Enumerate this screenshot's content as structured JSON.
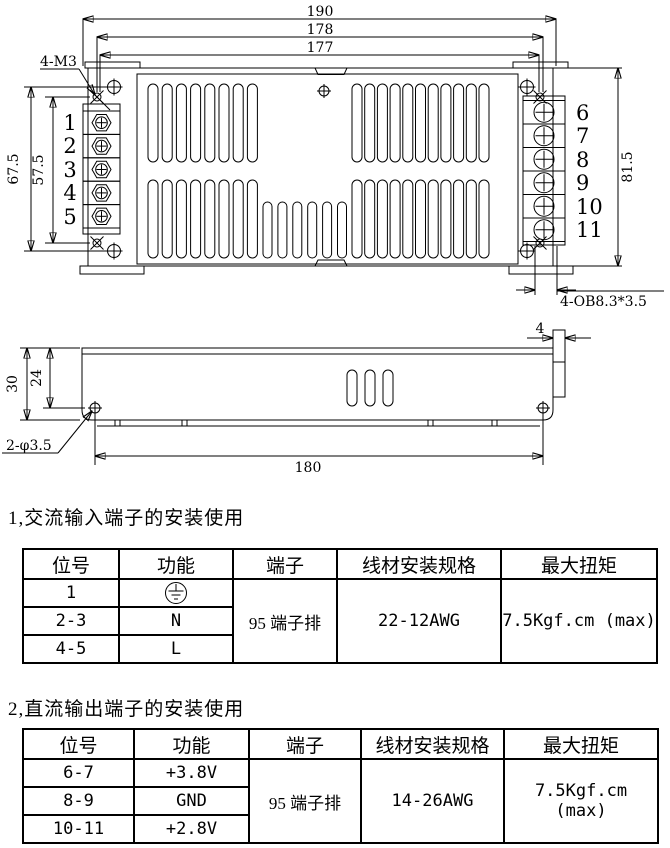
{
  "top_view": {
    "dim_width_overall": "190",
    "dim_width_mount": "178",
    "dim_width_inner": "177",
    "dim_height_outer": "67.5",
    "dim_height_mount": "57.5",
    "dim_height_right": "81.5",
    "label_mount_thread": "4-M3",
    "label_oblong_hole": "4-OB8.3*3.5",
    "left_terminals": [
      "1",
      "2",
      "3",
      "4",
      "5"
    ],
    "right_terminals": [
      "6",
      "7",
      "8",
      "9",
      "10",
      "11"
    ]
  },
  "side_view": {
    "dim_height": "30",
    "dim_hole_height": "24",
    "dim_flange": "4",
    "dim_hole_span": "180",
    "label_hole": "2-φ3.5"
  },
  "section_ac": {
    "heading": "1,交流输入端子的安装使用",
    "headers": [
      "位号",
      "功能",
      "端子",
      "线材安装规格",
      "最大扭矩"
    ],
    "rows": [
      {
        "pos": "1",
        "func": ""
      },
      {
        "pos": "2-3",
        "func": "N"
      },
      {
        "pos": "4-5",
        "func": "L"
      }
    ],
    "terminal": "95 端子排",
    "wire_spec": "22-12AWG",
    "torque": "7.5Kgf.cm (max)"
  },
  "section_dc": {
    "heading": "2,直流输出端子的安装使用",
    "headers": [
      "位号",
      "功能",
      "端子",
      "线材安装规格",
      "最大扭矩"
    ],
    "rows": [
      {
        "pos": "6-7",
        "func": "+3.8V"
      },
      {
        "pos": "8-9",
        "func": "GND"
      },
      {
        "pos": "10-11",
        "func": "+2.8V"
      }
    ],
    "terminal": "95 端子排",
    "wire_spec": "14-26AWG",
    "torque": "7.5Kgf.cm (max)"
  }
}
